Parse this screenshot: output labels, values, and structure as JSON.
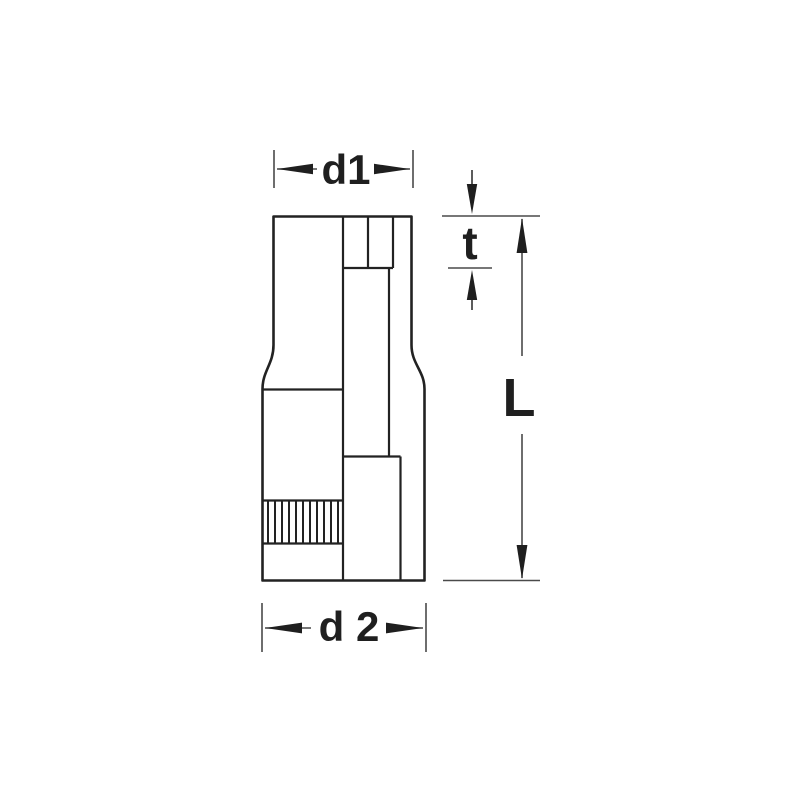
{
  "drawing": {
    "type": "technical-dimension-diagram",
    "subject": "socket-tool-side-section-view",
    "labels": {
      "d1": "d1",
      "t": "t",
      "length": "L",
      "d2": "d 2"
    },
    "colors": {
      "background": "#ffffff",
      "part_line": "#222222",
      "dimension_line": "#4a4a4a",
      "text": "#1f1f1f"
    }
  }
}
